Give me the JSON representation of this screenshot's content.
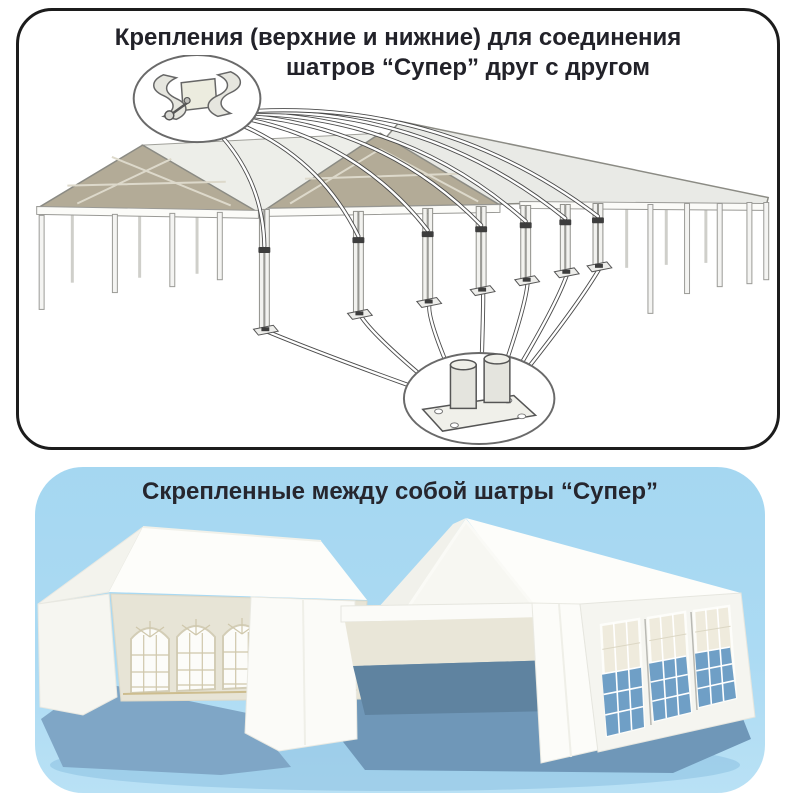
{
  "top_panel": {
    "title_line1": "Крепления (верхние и нижние) для соединения",
    "title_line2": "шатров “Супер” друг с другом",
    "icons": {
      "upper_connector": "pole-clamp-detail-icon",
      "lower_connector": "base-plate-detail-icon",
      "drawing": "joined-tent-frames-line-drawing"
    }
  },
  "bottom_panel": {
    "title": "Скрепленные между собой шатры “Супер”",
    "icons": {
      "illustration": "joined-white-tents-illustration"
    }
  },
  "colors": {
    "panel-blue": "#a9d9f2",
    "title-ink": "#222229",
    "border-ink": "#1c1c1c",
    "tan": "#b3ab97",
    "roof-gray": "#e9eae6",
    "line-gray": "#8b8b84",
    "interior": "#5f83a0",
    "window-blue": "#6f9fc6",
    "shadow-light": "#7fa6c6",
    "shadow-dark": "#6f97b8"
  }
}
